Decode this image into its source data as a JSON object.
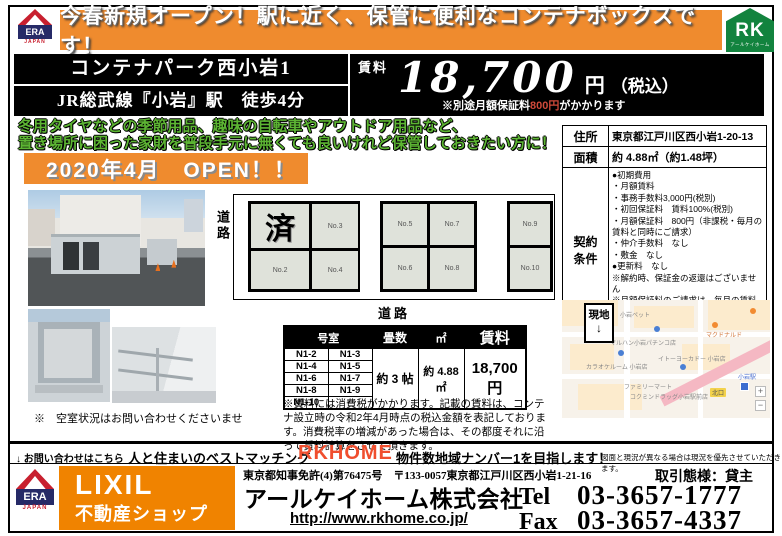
{
  "banner": {
    "text": "今春新規オープン！駅に近く、保管に便利なコンテナボックスです！"
  },
  "logos": {
    "era": "ERA",
    "era_sub": "JAPAN",
    "rk": "RK",
    "rk_sub": "アールケイホーム",
    "lixil_line1": "LIXIL",
    "lixil_line2": "不動産ショップ"
  },
  "title": {
    "name": "コンテナパーク西小岩1",
    "access": "JR総武線『小岩』駅　徒歩4分"
  },
  "price": {
    "label": "賃料",
    "amount": "18,700",
    "unit": "円",
    "tax": "（税込）",
    "note_prefix": "※別途月額保証料",
    "note_amount": "800円",
    "note_suffix": "がかかります"
  },
  "catchcopy": {
    "line1": "冬用タイヤなどの季節用品、趣味の自転車やアウトドア用品など、",
    "line2": "置き場所に困った家財を普段手元に無くても良いけれど保管しておきたい方に！",
    "open": "2020年4月　OPEN！！"
  },
  "photos": {
    "caption": "※　空室状況はお問い合わせくださいませ"
  },
  "diagram": {
    "road_left": "道路",
    "road_bottom": "道路",
    "block1": {
      "c1": "済",
      "c2": "No.3",
      "c3": "No.2",
      "c4": "No.4"
    },
    "block2": {
      "c1": "No.5",
      "c2": "No.7",
      "c3": "No.6",
      "c4": "No.8"
    },
    "block3": {
      "c1": "No.9",
      "c2": "No.10"
    }
  },
  "room_table": {
    "header_room": "号室",
    "header_tatami": "畳数",
    "header_sqm": "㎡",
    "header_rent": "賃料",
    "rows": [
      {
        "a": "N1-2",
        "b": "N1-3"
      },
      {
        "a": "N1-4",
        "b": "N1-5"
      },
      {
        "a": "N1-6",
        "b": "N1-7"
      },
      {
        "a": "N1-8",
        "b": "N1-9"
      },
      {
        "a": "N1-10",
        "b": ""
      }
    ],
    "tatami": "約 3 帖",
    "sqm": "約 4.88㎡",
    "rent": "18,700円",
    "note": "※賃料には消費税がかかります。記載の賃料は、コンテナ設立時の令和2年4月時点の税込金額を表記しております。消費税率の増減があった場合は、その都度それに沿って賃料計算をさせて頂きます。"
  },
  "info": {
    "address_label": "住所",
    "address": "東京都江戸川区西小岩1-20-13",
    "area_label": "面積",
    "area": "約 4.88㎡（約1.48坪）",
    "terms_label": "契約条件",
    "terms": [
      "●初期費用",
      "・月額賃料",
      "・事務手数料3,000円(税別)",
      "・初回保証料　賃料100%(税別)",
      "・月額保証料　800円（非課税・毎月の賃料と同時にご請求）",
      "・仲介手数料　なし",
      "・敷金　なし",
      "●更新料　なし",
      "※解約時、保証金の返還はございません",
      "※月額保証料のご請求は、毎月の賃料と同時に行います",
      "※更新は1年毎に自動更新となります"
    ]
  },
  "map": {
    "site_label": "現地",
    "site_arrow": "↓",
    "labels": [
      "小岩ペット",
      "マルハン小岩パチンコ店",
      "マクドナルド",
      "カラオケルーム 小岩店",
      "イトーヨーカドー 小岩店",
      "ファミリーマート",
      "コクミンドラッグ小岩駅前店",
      "北口",
      "小岩駅"
    ],
    "zoom_in": "+",
    "zoom_out": "−"
  },
  "footer": {
    "contact": "↓ お問い合わせはこちら",
    "slogan": "人と住まいのベストマッチング",
    "brand": "RKHOME",
    "goal": "物件数地域ナンバー1を目指します！",
    "disclaimer": "図面と現況が異なる場合は現況を優先させていただきます。",
    "license": "東京都知事免許(4)第76475号　〒133-0057東京都江戸川区西小岩1-21-16",
    "deal_type": "取引態様：貸主",
    "company": "アールケイホーム株式会社",
    "url": "http://www.rkhome.co.jp/",
    "tel_label": "Tel",
    "tel": "03-3657-1777",
    "fax_label": "Fax",
    "fax": "03-3657-4337"
  },
  "colors": {
    "accent_orange": "#ef8b2e",
    "brand_red": "#f04e2e",
    "rk_green": "#12833e",
    "catch_green": "#5cb433"
  }
}
